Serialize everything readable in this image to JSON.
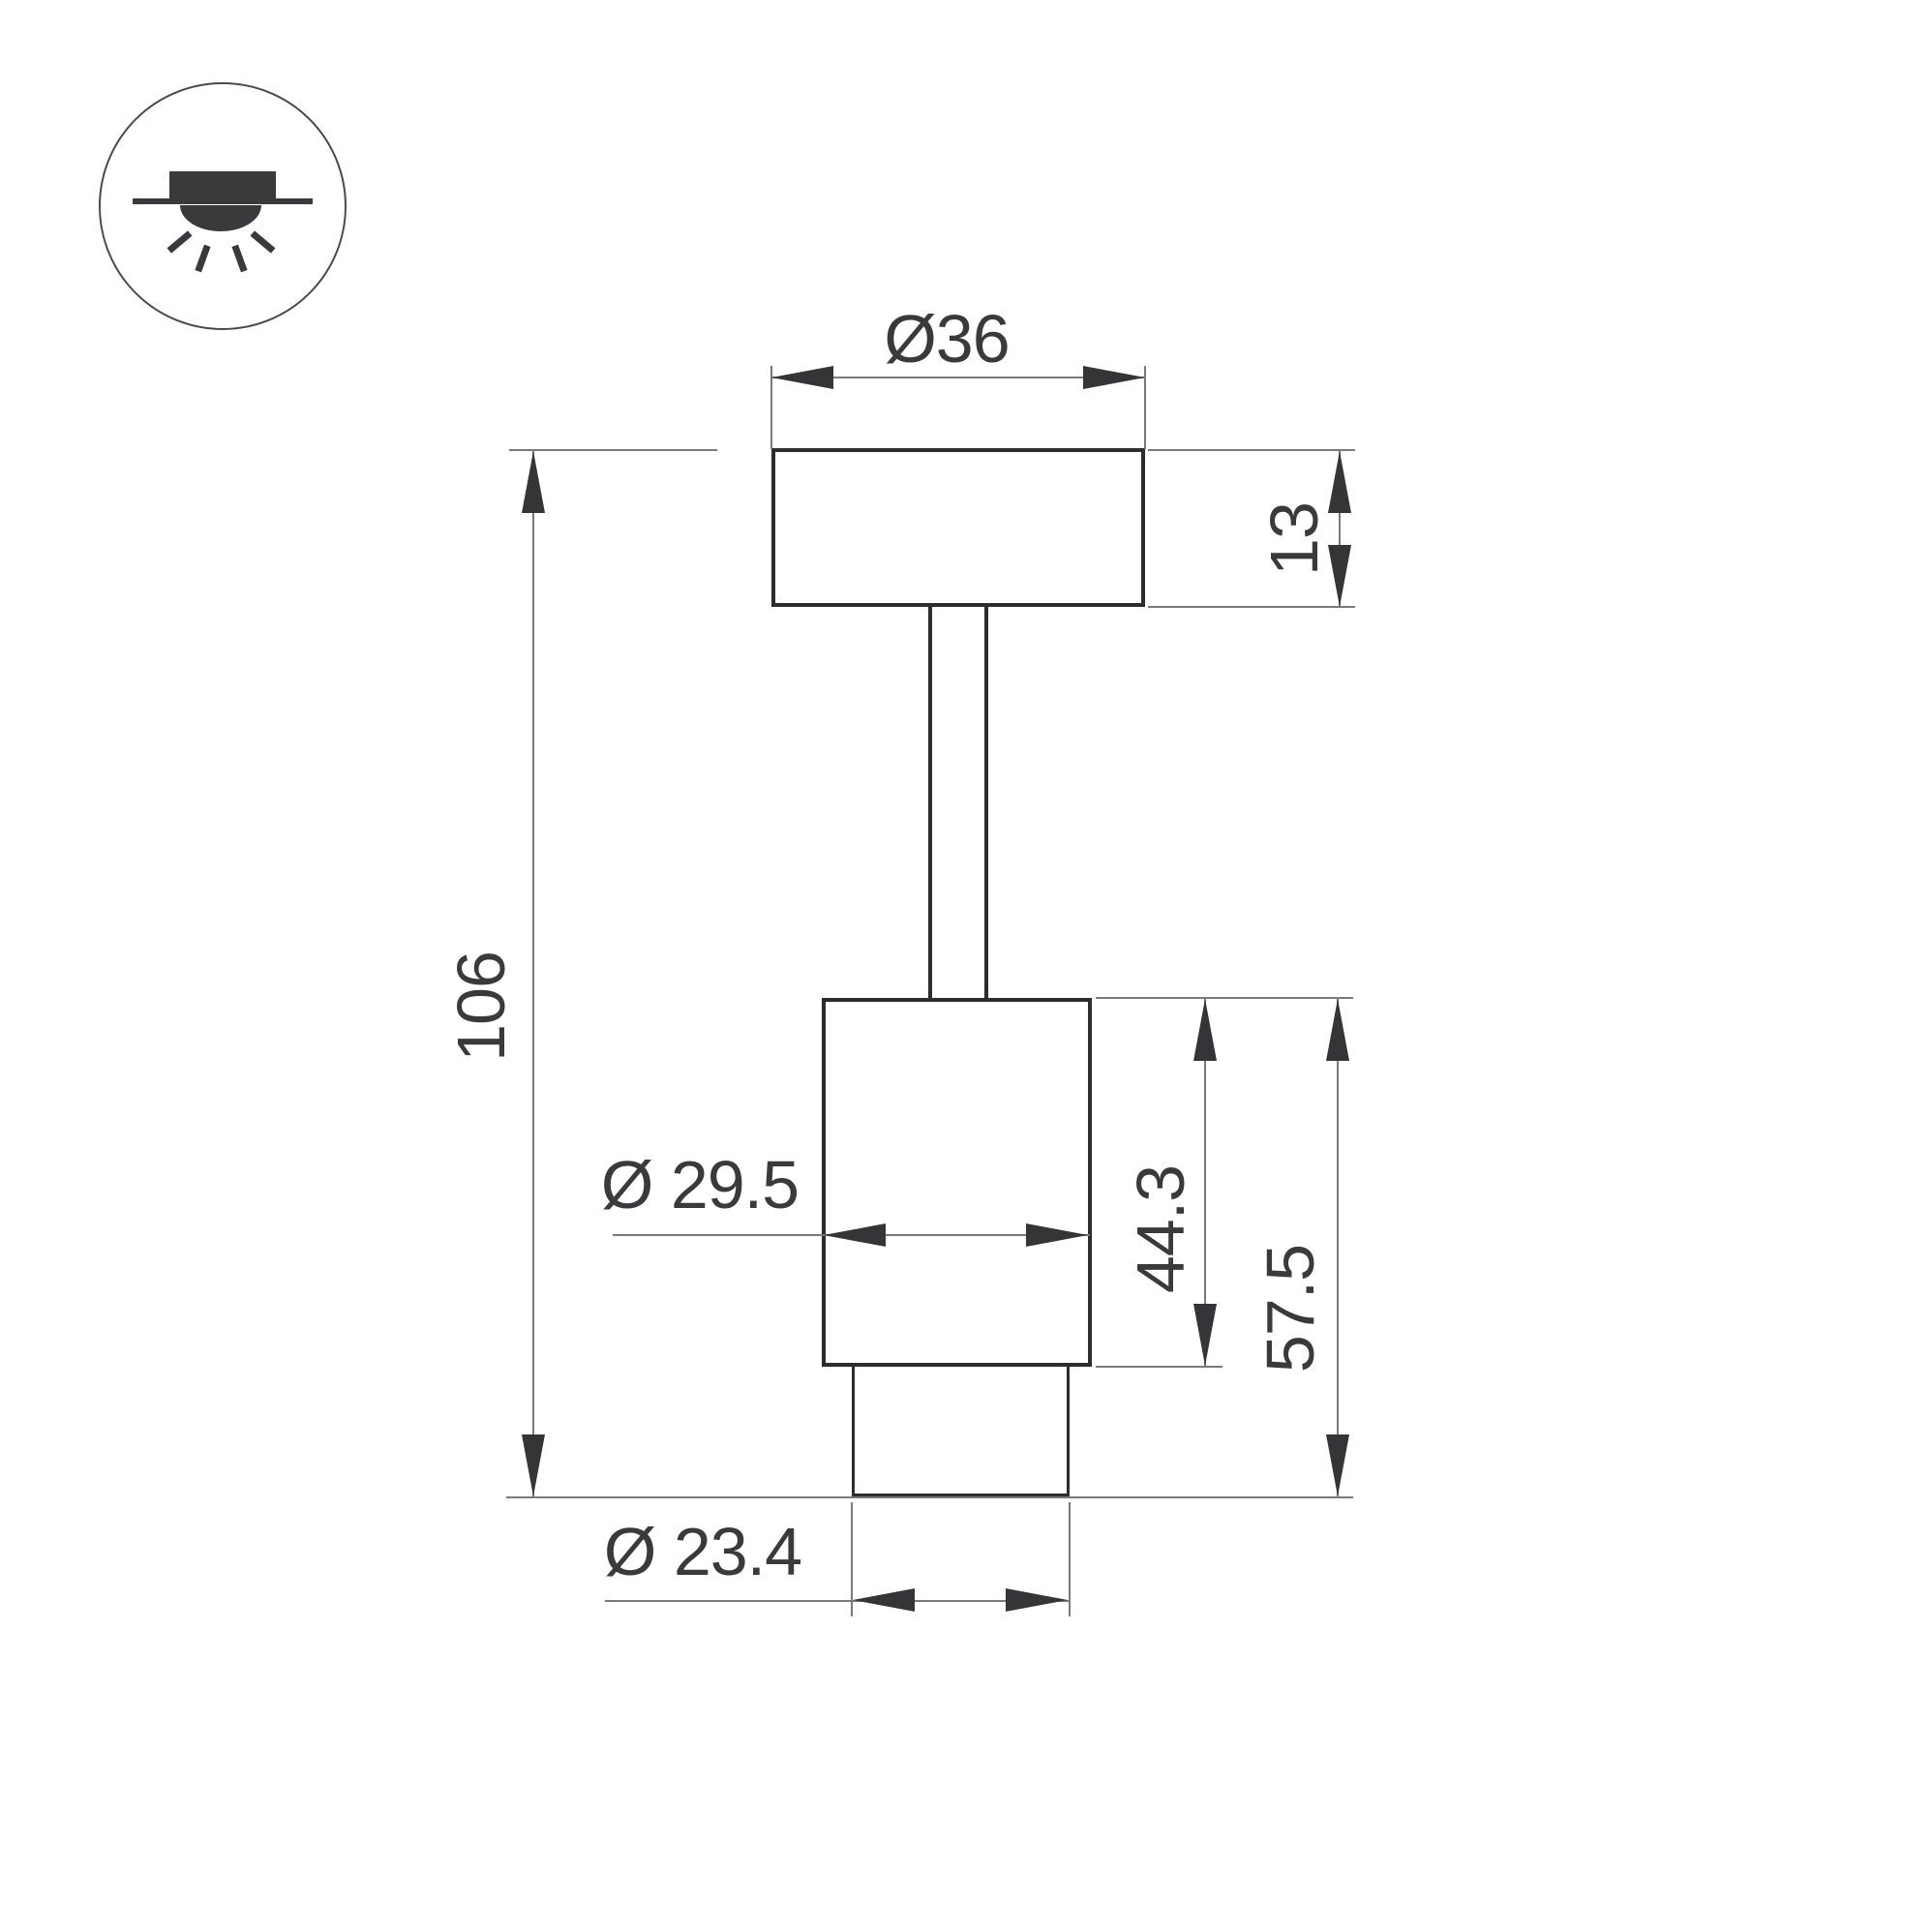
{
  "colors": {
    "background": "#ffffff",
    "object_line": "#2d2d2f",
    "dimension_line": "#7a7a7c",
    "arrow": "#353537",
    "text": "#3a3a3c",
    "icon": "#3a3a3c"
  },
  "icon": {
    "name": "recessed-downlight-symbol"
  },
  "dimensions": {
    "top_diameter": "Ø36",
    "plate_thickness": "13",
    "overall_height": "106",
    "body_diameter": "Ø 29.5",
    "body_height": "44.3",
    "lower_height": "57.5",
    "trim_diameter": "Ø 23.4"
  }
}
